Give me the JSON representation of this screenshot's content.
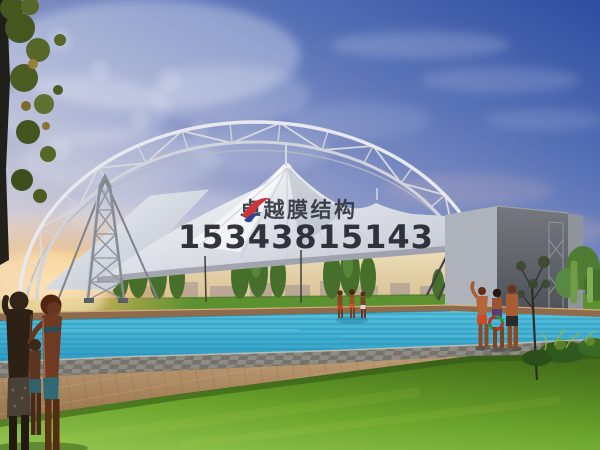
{
  "page": {
    "type": "architectural-photo-render",
    "subject": "tensile membrane structure canopy with steel arch truss over a swimming pool at dusk"
  },
  "watermark": {
    "company_name": "卓越膜结构",
    "phone_number": "15343815143"
  },
  "palette": {
    "watermark_text": "#32353e",
    "watermark_phone": "#23252d",
    "logo_red": "#c8252c",
    "logo_blue": "#1e3a8c",
    "sky_deep_blue": "#2e4da0",
    "sky_pale": "#ddd6d8",
    "sunset_glow": "#f5bc6e",
    "membrane_white": "#f2f3f7",
    "truss_steel": "#d9dbe2",
    "pool_water": "#3fb0d4",
    "pool_stripe": "#1f86ad",
    "coping_brown": "#8f6b4c",
    "deck_gray": "#8f8c85",
    "walkway_tan": "#b69066",
    "grass_green": "#6ca52c",
    "tree_green": "#47702c",
    "wall_gray": "#5d6066"
  }
}
